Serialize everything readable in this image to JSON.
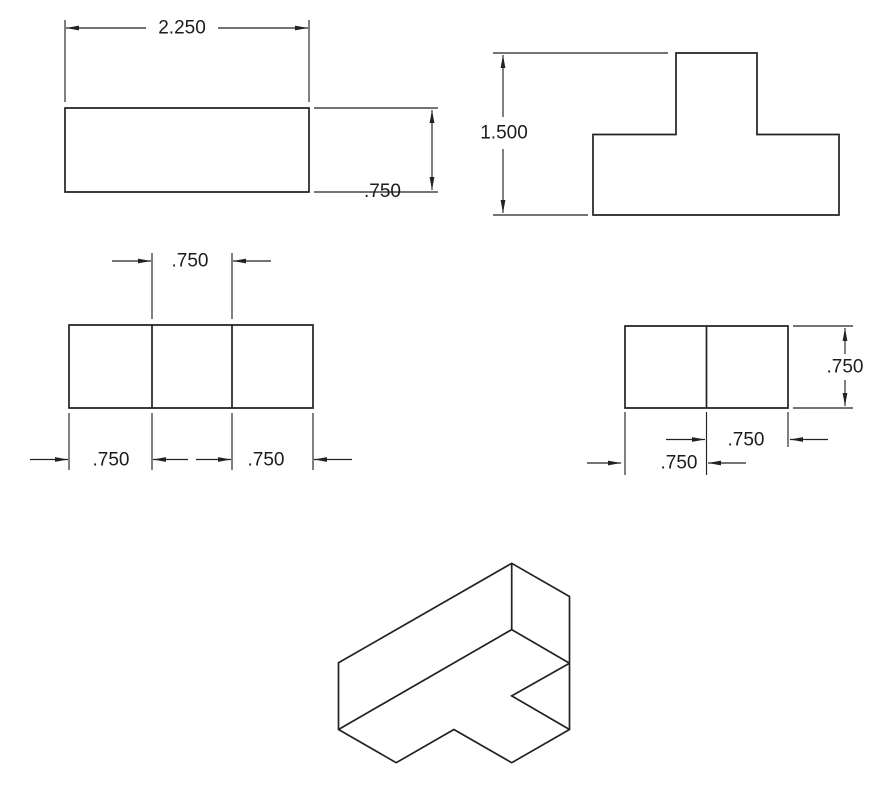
{
  "drawing": {
    "title": "multiview-technical-drawing-t-block",
    "width": 877,
    "height": 806,
    "background_color": "#ffffff",
    "line_color": "#222222",
    "text_color": "#1c1c1c",
    "font_size": 19,
    "outline_stroke": 1.7,
    "dim_stroke": 1.15,
    "arrow_length": 13,
    "arrow_half_width": 2.4,
    "views": [
      {
        "id": "top-left-rectangle-view",
        "polygons": [
          [
            [
              65,
              108
            ],
            [
              309,
              108
            ],
            [
              309,
              192
            ],
            [
              65,
              192
            ]
          ]
        ],
        "polylines": [],
        "lines": []
      },
      {
        "id": "top-right-t-profile-view",
        "polygons": [
          [
            [
              593,
              134.5
            ],
            [
              676,
              134.5
            ],
            [
              676,
              53
            ],
            [
              757,
              53
            ],
            [
              757,
              134.5
            ],
            [
              839,
              134.5
            ],
            [
              839,
              215
            ],
            [
              593,
              215
            ]
          ]
        ],
        "polylines": [],
        "lines": []
      },
      {
        "id": "middle-left-rectangle-view",
        "polygons": [
          [
            [
              69,
              325
            ],
            [
              313,
              325
            ],
            [
              313,
              408
            ],
            [
              69,
              408
            ]
          ]
        ],
        "polylines": [],
        "lines": [
          [
            152,
            325,
            152,
            408
          ],
          [
            232,
            325,
            232,
            408
          ]
        ]
      },
      {
        "id": "middle-right-rectangle-view",
        "polygons": [
          [
            [
              625,
              326
            ],
            [
              788,
              326
            ],
            [
              788,
              408
            ],
            [
              625,
              408
            ]
          ]
        ],
        "polylines": [],
        "lines": [
          [
            706.5,
            326,
            706.5,
            408
          ]
        ]
      },
      {
        "id": "isometric-view",
        "polygons": [
          [
            [
              511.7,
              563.3
            ],
            [
              569.5,
              596.5
            ],
            [
              569.5,
              729.5
            ],
            [
              511.7,
              762.7
            ],
            [
              453.9,
              729.5
            ],
            [
              396.2,
              762.7
            ],
            [
              338.5,
              729.5
            ],
            [
              338.5,
              662.8
            ]
          ]
        ],
        "polylines": [
          [
            [
              511.7,
              563.3
            ],
            [
              511.7,
              629.6
            ],
            [
              338.5,
              729.5
            ]
          ],
          [
            [
              511.7,
              629.6
            ],
            [
              569.5,
              663.25
            ]
          ],
          [
            [
              569.5,
              663.25
            ],
            [
              511.7,
              695.9
            ],
            [
              569.5,
              729.5
            ]
          ]
        ],
        "lines": []
      }
    ],
    "dimensions": [
      {
        "id": "dim-width-2250",
        "label": "2.250",
        "label_x": 182,
        "label_y": 28,
        "lines": [
          [
            65,
            20,
            65,
            102
          ],
          [
            309,
            20,
            309,
            102
          ],
          [
            66,
            28,
            146,
            28
          ],
          [
            218,
            28,
            308,
            28
          ]
        ],
        "arrows": [
          [
            66,
            28,
            "left"
          ],
          [
            308,
            28,
            "right"
          ]
        ]
      },
      {
        "id": "dim-height-750-top-view",
        "label": ".750",
        "label_x": 382.5,
        "label_y": 191.5,
        "lines": [
          [
            314,
            108,
            438,
            108
          ],
          [
            314,
            192,
            438,
            192
          ],
          [
            432,
            110,
            432,
            190
          ]
        ],
        "arrows": [
          [
            432,
            110,
            "up"
          ],
          [
            432,
            190,
            "down"
          ]
        ]
      },
      {
        "id": "dim-height-1500",
        "label": "1.500",
        "label_x": 504,
        "label_y": 133,
        "lines": [
          [
            493,
            53,
            668,
            53
          ],
          [
            493,
            215,
            588,
            215
          ],
          [
            503,
            55,
            503,
            117
          ],
          [
            503,
            149,
            503,
            213
          ]
        ],
        "arrows": [
          [
            503,
            55,
            "up"
          ],
          [
            503,
            213,
            "down"
          ]
        ]
      },
      {
        "id": "dim-750-middle-top",
        "label": ".750",
        "label_x": 190,
        "label_y": 261,
        "lines": [
          [
            152,
            253,
            152,
            319
          ],
          [
            232,
            253,
            232,
            319
          ],
          [
            112,
            261,
            151,
            261
          ],
          [
            233,
            261,
            271,
            261
          ]
        ],
        "arrows": [
          [
            151,
            261,
            "right"
          ],
          [
            233,
            261,
            "left"
          ]
        ]
      },
      {
        "id": "dim-750-bottom-left-segment",
        "label": ".750",
        "label_x": 111,
        "label_y": 460,
        "lines": [
          [
            69,
            413,
            69,
            470
          ],
          [
            152,
            413,
            152,
            470
          ],
          [
            30,
            459.5,
            68,
            459.5
          ],
          [
            153,
            459.5,
            188,
            459.5
          ]
        ],
        "arrows": [
          [
            68,
            459.5,
            "right"
          ],
          [
            153,
            459.5,
            "left"
          ]
        ]
      },
      {
        "id": "dim-750-bottom-right-segment",
        "label": ".750",
        "label_x": 266,
        "label_y": 460,
        "lines": [
          [
            232,
            413,
            232,
            470
          ],
          [
            313,
            413,
            313,
            470
          ],
          [
            196,
            459.5,
            231,
            459.5
          ],
          [
            314,
            459.5,
            352,
            459.5
          ]
        ],
        "arrows": [
          [
            231,
            459.5,
            "right"
          ],
          [
            314,
            459.5,
            "left"
          ]
        ]
      },
      {
        "id": "dim-750-side-height",
        "label": ".750",
        "label_x": 845,
        "label_y": 367,
        "lines": [
          [
            793,
            326,
            853,
            326
          ],
          [
            793,
            408,
            853,
            408
          ],
          [
            845,
            328,
            845,
            354
          ],
          [
            845,
            380,
            845,
            406
          ]
        ],
        "arrows": [
          [
            845,
            328,
            "up"
          ],
          [
            845,
            406,
            "down"
          ]
        ]
      },
      {
        "id": "dim-750-side-upper",
        "label": ".750",
        "label_x": 746,
        "label_y": 440,
        "lines": [
          [
            706.5,
            412,
            706.5,
            475
          ],
          [
            788,
            412,
            788,
            447
          ],
          [
            666,
            439.5,
            705,
            439.5
          ],
          [
            790,
            439.5,
            828,
            439.5
          ]
        ],
        "arrows": [
          [
            705,
            439.5,
            "right"
          ],
          [
            790,
            439.5,
            "left"
          ]
        ]
      },
      {
        "id": "dim-750-side-lower",
        "label": ".750",
        "label_x": 679,
        "label_y": 463,
        "lines": [
          [
            625,
            412,
            625,
            475
          ],
          [
            587,
            463,
            621,
            463
          ],
          [
            708,
            463,
            746,
            463
          ]
        ],
        "arrows": [
          [
            621,
            463,
            "right"
          ],
          [
            708,
            463,
            "left"
          ]
        ]
      }
    ]
  }
}
